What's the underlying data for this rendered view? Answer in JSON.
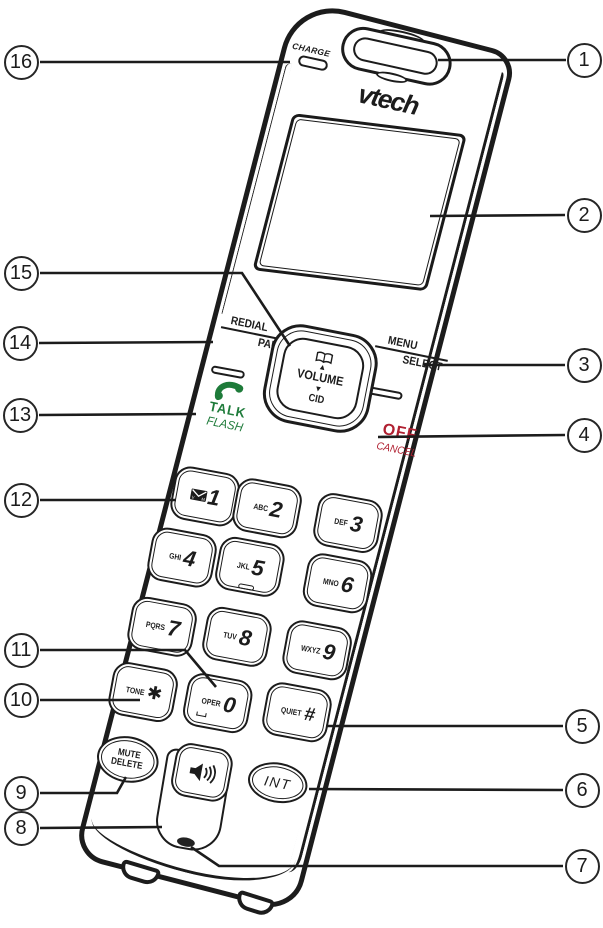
{
  "diagram": {
    "type": "cordless-handset-front-diagram",
    "brand_logo": "vtech",
    "charge_label": "CHARGE",
    "nav": {
      "phonebook_icon": "phonebook-icon",
      "up_arrow": "▲",
      "volume": "VOLUME",
      "down_arrow": "▼",
      "cid": "CID"
    },
    "redial_pause": {
      "top": "REDIAL",
      "bottom": "PAUSE"
    },
    "menu_select": {
      "top": "MENU",
      "bottom": "SELECT"
    },
    "talk_flash": {
      "top": "TALK",
      "bottom": "FLASH",
      "icon": "handset-icon"
    },
    "off_cancel": {
      "top": "OFF",
      "bottom": "CANCEL"
    },
    "mute_delete": {
      "top": "MUTE",
      "bottom": "DELETE"
    },
    "int_label": "INT",
    "speaker_icon": "speakerphone-icon",
    "keys": [
      {
        "label": "",
        "digit": "1",
        "icon": "voicemail-envelope-icon",
        "icon_letters": [
          "V",
          "M"
        ]
      },
      {
        "label": "ABC",
        "digit": "2"
      },
      {
        "label": "DEF",
        "digit": "3"
      },
      {
        "label": "GHI",
        "digit": "4"
      },
      {
        "label": "JKL",
        "digit": "5",
        "nub": true
      },
      {
        "label": "MNO",
        "digit": "6"
      },
      {
        "label": "PQRS",
        "digit": "7"
      },
      {
        "label": "TUV",
        "digit": "8"
      },
      {
        "label": "WXYZ",
        "digit": "9"
      },
      {
        "label": "TONE",
        "digit": "✱"
      },
      {
        "label": "OPER",
        "digit": "0",
        "oper_mark": true
      },
      {
        "label": "QUIET",
        "digit": "#"
      }
    ],
    "colors": {
      "ink": "#1c1c1c",
      "talk_green": "#1e7b3a",
      "off_red": "#b02031",
      "background": "#ffffff"
    }
  },
  "callouts": [
    {
      "n": "1",
      "cx": 584,
      "cy": 60,
      "line": [
        [
          438,
          60
        ],
        [
          566,
          60
        ]
      ]
    },
    {
      "n": "2",
      "cx": 584,
      "cy": 215,
      "line": [
        [
          430,
          216
        ],
        [
          565,
          215
        ]
      ]
    },
    {
      "n": "3",
      "cx": 584,
      "cy": 365,
      "line": [
        [
          424,
          365
        ],
        [
          565,
          365
        ]
      ]
    },
    {
      "n": "4",
      "cx": 584,
      "cy": 435,
      "line": [
        [
          378,
          437
        ],
        [
          565,
          435
        ]
      ]
    },
    {
      "n": "5",
      "cx": 582,
      "cy": 726,
      "line": [
        [
          326,
          726
        ],
        [
          563,
          726
        ]
      ]
    },
    {
      "n": "6",
      "cx": 582,
      "cy": 790,
      "line": [
        [
          309,
          789
        ],
        [
          563,
          790
        ]
      ]
    },
    {
      "n": "7",
      "cx": 582,
      "cy": 866,
      "line": [
        [
          191,
          847
        ],
        [
          219,
          866
        ],
        [
          563,
          866
        ]
      ]
    },
    {
      "n": "8",
      "cx": 21,
      "cy": 828,
      "line": [
        [
          40,
          828
        ],
        [
          162,
          827
        ]
      ]
    },
    {
      "n": "9",
      "cx": 21,
      "cy": 793,
      "line": [
        [
          40,
          793
        ],
        [
          117,
          793
        ],
        [
          126,
          777
        ]
      ]
    },
    {
      "n": "10",
      "cx": 21,
      "cy": 700,
      "line": [
        [
          40,
          700
        ],
        [
          140,
          700
        ]
      ]
    },
    {
      "n": "11",
      "cx": 21,
      "cy": 650,
      "line": [
        [
          40,
          650
        ],
        [
          185,
          650
        ],
        [
          216,
          687
        ]
      ]
    },
    {
      "n": "12",
      "cx": 21,
      "cy": 500,
      "line": [
        [
          40,
          500
        ],
        [
          176,
          500
        ]
      ]
    },
    {
      "n": "13",
      "cx": 20,
      "cy": 415,
      "line": [
        [
          39,
          415
        ],
        [
          196,
          414
        ]
      ]
    },
    {
      "n": "14",
      "cx": 20,
      "cy": 343,
      "line": [
        [
          39,
          343
        ],
        [
          213,
          342
        ]
      ]
    },
    {
      "n": "15",
      "cx": 21,
      "cy": 273,
      "line": [
        [
          40,
          273
        ],
        [
          242,
          273
        ],
        [
          290,
          346
        ]
      ]
    },
    {
      "n": "16",
      "cx": 21,
      "cy": 62,
      "line": [
        [
          40,
          62
        ],
        [
          290,
          62
        ]
      ]
    }
  ]
}
